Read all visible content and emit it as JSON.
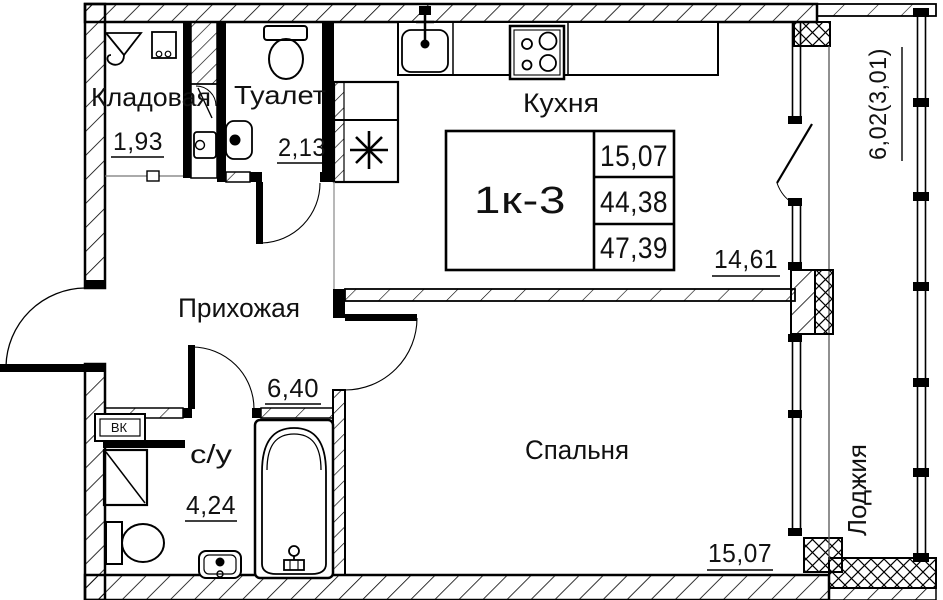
{
  "unit": {
    "label": "1к-3",
    "table_rows": [
      "15,07",
      "44,38",
      "47,39"
    ]
  },
  "rooms": {
    "storage": {
      "name": "Кладовая",
      "area": "1,93"
    },
    "toilet": {
      "name": "Туалет",
      "area": "2,13"
    },
    "kitchen": {
      "name": "Кухня",
      "area": "14,61"
    },
    "hallway": {
      "name": "Прихожая",
      "area": "6,40"
    },
    "bathroom": {
      "name": "с/у",
      "area": "4,24"
    },
    "bedroom": {
      "name": "Спальня",
      "area": "15,07"
    },
    "loggia": {
      "name": "Лоджия",
      "area": "6,02(3,01)"
    }
  },
  "annotations": {
    "utility_box": "ВК"
  },
  "colors": {
    "line": "#000000",
    "background": "#ffffff"
  }
}
